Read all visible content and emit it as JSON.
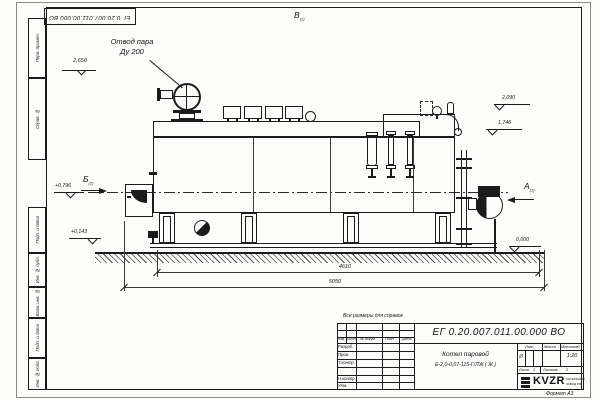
{
  "drawing": {
    "stamp_top": "ЕГ 0.20.007.011.00.000  ВО",
    "steam_outlet_note": {
      "line1": "Отвод пара",
      "line2": "Ду 200"
    },
    "reference_note": "Все размеры для справок",
    "views": {
      "top": "В",
      "left": "Б",
      "right": "А",
      "sheet_ref": "(2)"
    },
    "elevations": {
      "steam_valve": "2,650",
      "front_upper": "+0,796",
      "front_lower": "+0,143",
      "rear_upper": "2,090",
      "rear_mid": "1,746",
      "ground": "0,000"
    },
    "dimensions": {
      "boiler_length": "4610",
      "overall_length": "5050"
    }
  },
  "margin_labels": [
    "Перв. примен.",
    "Справ. №",
    "Подп. и дата",
    "Инв. № дубл.",
    "Взам. инв. №",
    "Подп. и дата",
    "Инв. № подл."
  ],
  "title_block": {
    "doc_number": "ЕГ 0.20.007.011.00.000  ВО",
    "product_line1": "Котел паровой",
    "product_line2": "Е-2,0-0,07-115-Г/ЛЖ ( Ж )",
    "col_izm": "Изм.",
    "col_list": "Лист",
    "col_doc": "№ докум.",
    "col_sign": "Подп.",
    "col_date": "Дата",
    "row_labels": [
      "Разраб.",
      "Пров.",
      "Т.контр.",
      "",
      "Н.контр.",
      "Утв."
    ],
    "lit_header": "Лит.",
    "mass_header": "Масса",
    "scale_header": "Масштаб",
    "lit_value": "И",
    "scale_value": "1:20",
    "sheet_label": "Лист",
    "sheet_number": "1",
    "sheets_label": "Листов",
    "sheets_total": "2",
    "logo_text": "KVZR",
    "logo_caption1": "КОТЕЛЬНЫЙ",
    "logo_caption2": "ЗАВОД РФ",
    "format_note": "Формат А3"
  },
  "colors": {
    "ink": "#1b1b1b",
    "paper": "#ffffff"
  }
}
